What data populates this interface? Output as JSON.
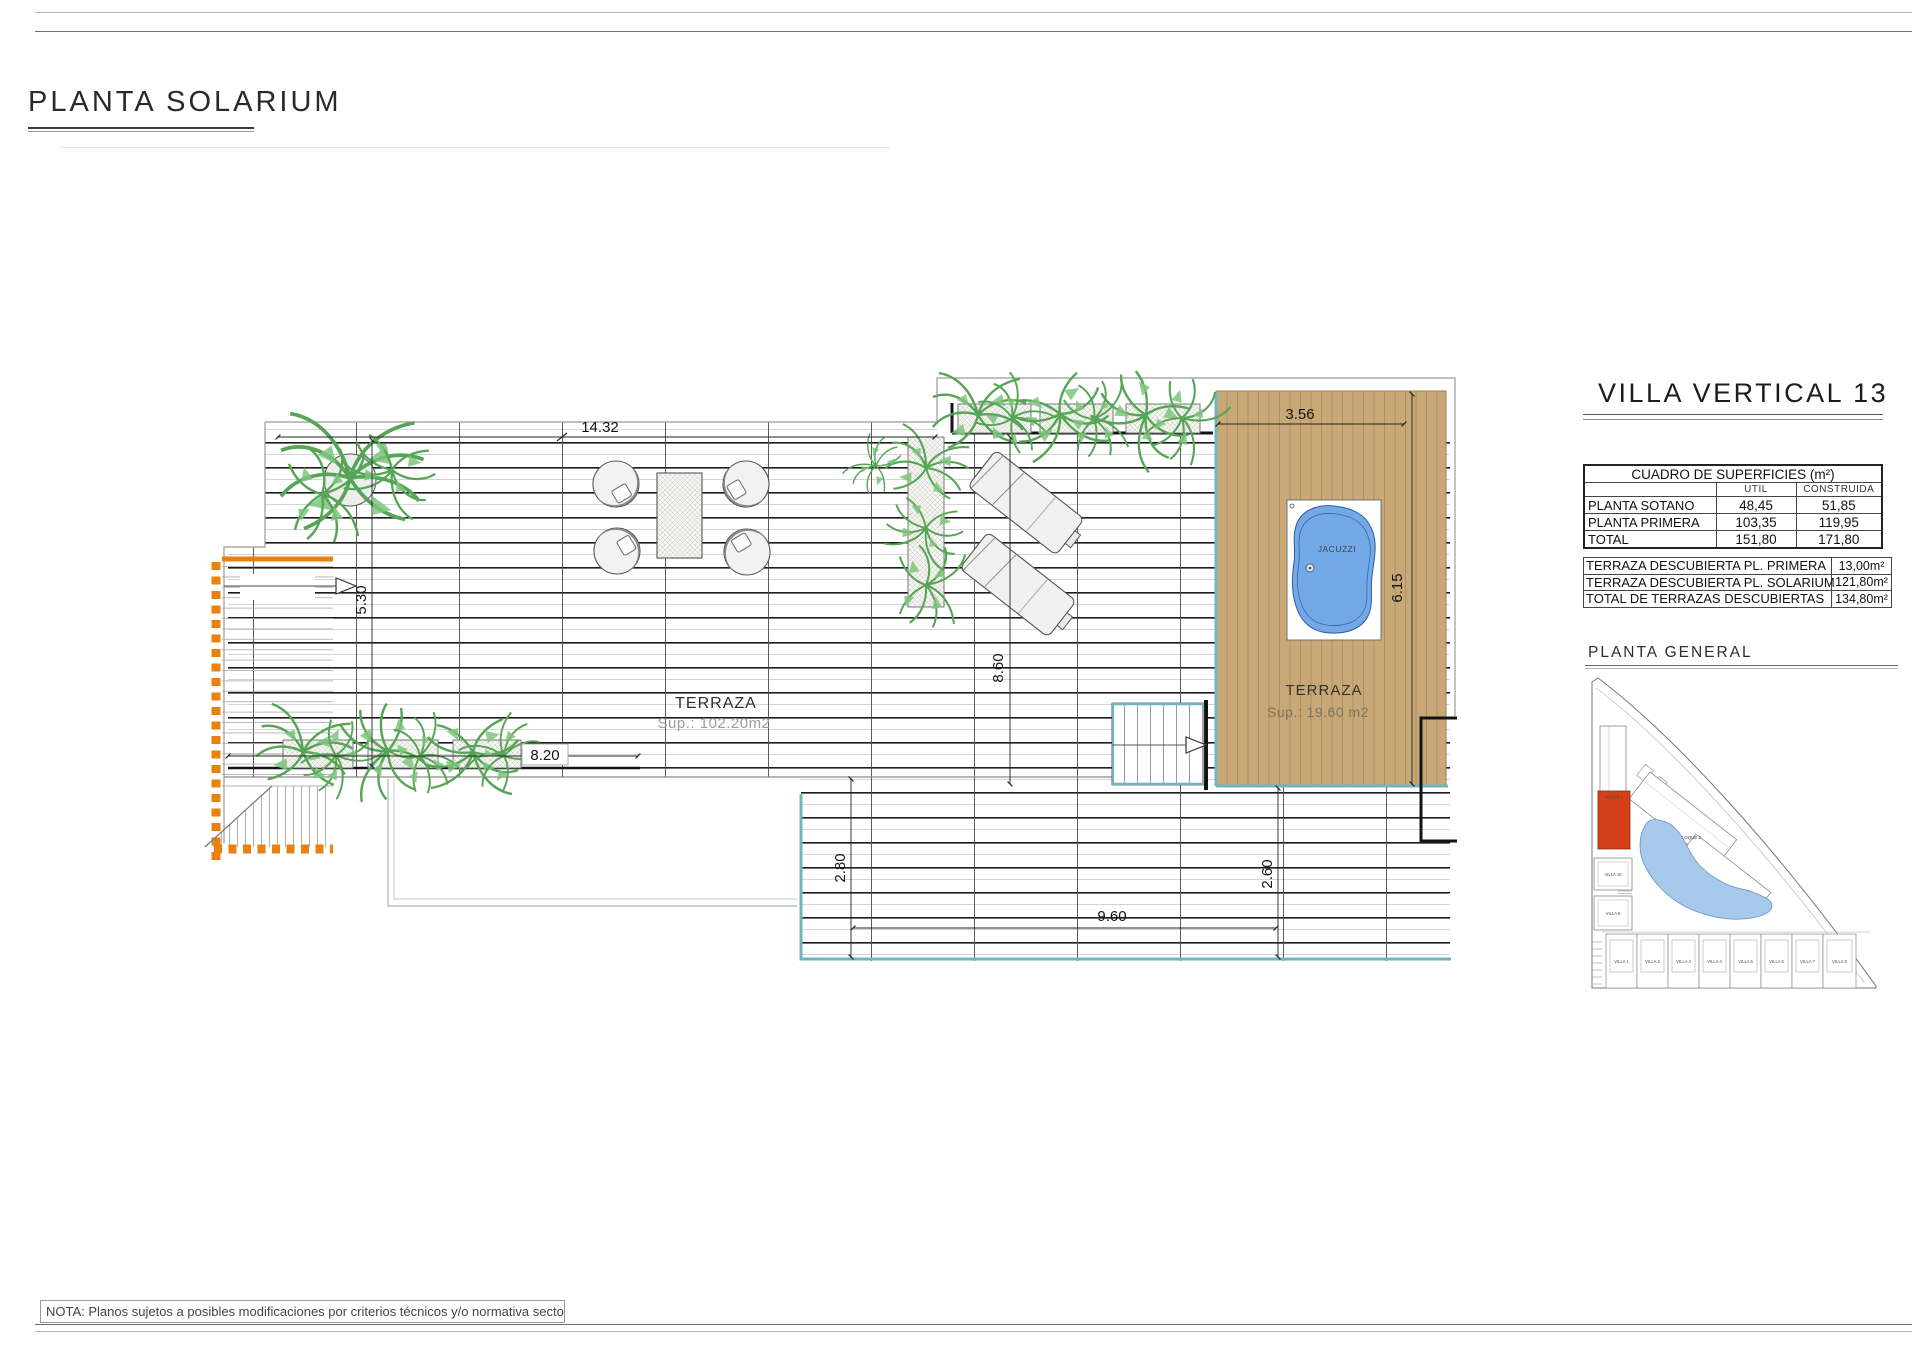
{
  "page": {
    "title": "PLANTA SOLARIUM",
    "note": "NOTA: Planos sujetos a posibles modificaciones por criterios técnicos y/o normativa sectorial."
  },
  "plan": {
    "terraza_main": {
      "name": "TERRAZA",
      "sup": "Sup.: 102.20m2"
    },
    "terraza_solarium": {
      "name": "TERRAZA",
      "sup": "Sup.: 19.60 m2"
    },
    "jacuzzi_label": "JACUZZI",
    "dims": {
      "top_width": "14.32",
      "deck_width": "3.56",
      "left_height": "5.30",
      "deck_height": "6.15",
      "mid_height": "8.60",
      "planter_width": "8.20",
      "lower_left_height": "2.80",
      "lower_right_height": "2.60",
      "lower_width": "9.60"
    }
  },
  "panel": {
    "title": "VILLA VERTICAL 13",
    "surfaces": {
      "title": "CUADRO DE SUPERFICIES (m²)",
      "col_util": "UTIL",
      "col_construida": "CONSTRUIDA",
      "rows": [
        {
          "label": "PLANTA SOTANO",
          "util": "48,45",
          "construida": "51,85"
        },
        {
          "label": "PLANTA PRIMERA",
          "util": "103,35",
          "construida": "119,95"
        },
        {
          "label": "TOTAL",
          "util": "151,80",
          "construida": "171,80"
        }
      ]
    },
    "terraces": {
      "rows": [
        {
          "label": "TERRAZA DESCUBIERTA PL. PRIMERA",
          "value": "13,00m²"
        },
        {
          "label": "TERRAZA DESCUBIERTA PL. SOLARIUM",
          "value": "121,80m²"
        },
        {
          "label": "TOTAL DE TERRAZAS DESCUBIERTAS",
          "value": "134,80m²"
        }
      ]
    },
    "general": {
      "title": "PLANTA GENERAL",
      "bloque1": "BLOQUE 1",
      "bloque2": "BLOQUE 2",
      "villa10": "VILLA 10",
      "villa9": "VILLA 9",
      "villas": [
        "VILLA 1",
        "VILLA 2",
        "VILLA 3",
        "VILLA 4",
        "VILLA 5",
        "VILLA 6",
        "VILLA 7",
        "VILLA 8"
      ]
    }
  },
  "colors": {
    "deck_wood": "#C9A878",
    "accent_teal": "#6FB5BD",
    "accent_orange": "#E8820C",
    "jacuzzi_blue": "#74A9E8",
    "plan_green": "#55A555",
    "site_red": "#D4401A",
    "site_water": "#A6C9EC"
  }
}
